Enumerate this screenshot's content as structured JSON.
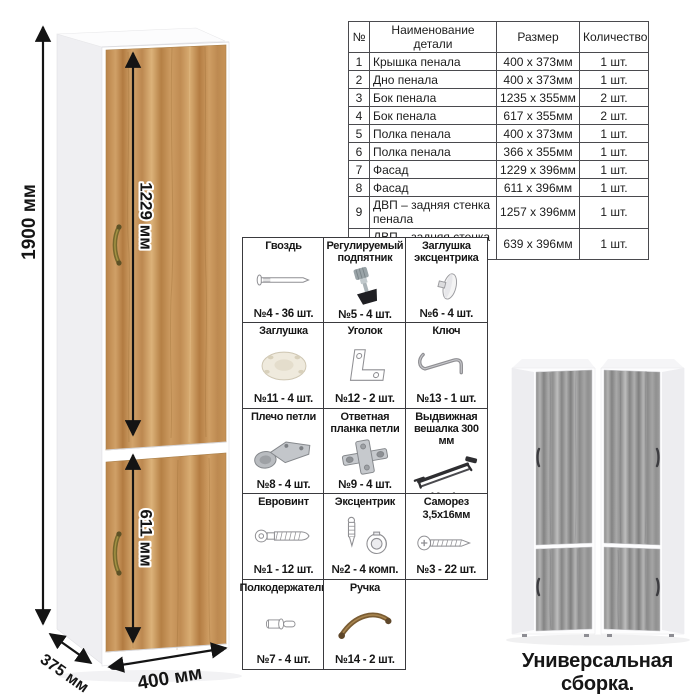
{
  "parts_table": {
    "headers": [
      "№",
      "Наименование детали",
      "Размер",
      "Количество"
    ],
    "rows": [
      [
        "1",
        "Крышка пенала",
        "400 х 373мм",
        "1 шт."
      ],
      [
        "2",
        "Дно пенала",
        "400 х 373мм",
        "1 шт."
      ],
      [
        "3",
        "Бок пенала",
        "1235 х 355мм",
        "2 шт."
      ],
      [
        "4",
        "Бок пенала",
        "617 х 355мм",
        "2 шт."
      ],
      [
        "5",
        "Полка пенала",
        "400 х 373мм",
        "1 шт."
      ],
      [
        "6",
        "Полка пенала",
        "366 х 355мм",
        "1 шт."
      ],
      [
        "7",
        "Фасад",
        "1229 х 396мм",
        "1 шт."
      ],
      [
        "8",
        "Фасад",
        "611 х 396мм",
        "1 шт."
      ],
      [
        "9",
        "ДВП – задняя стенка пенала",
        "1257 х 396мм",
        "1 шт."
      ],
      [
        "10",
        "ДВП – задняя стенка пенала",
        "639 х 396мм",
        "1 шт."
      ]
    ]
  },
  "hardware": {
    "rows": [
      [
        {
          "name": "Гвоздь",
          "qty": "№4 - 36 шт.",
          "icon": "nail-icon"
        },
        {
          "name": "Регулируемый подпятник",
          "qty": "№5 - 4 шт.",
          "icon": "adjustable-foot-icon"
        },
        {
          "name": "Заглушка эксцентрика",
          "qty": "№6 - 4 шт.",
          "icon": "cam-cap-icon"
        }
      ],
      [
        {
          "name": "Заглушка",
          "qty": "№11 - 4 шт.",
          "icon": "plug-icon"
        },
        {
          "name": "Уголок",
          "qty": "№12 - 2 шт.",
          "icon": "corner-bracket-icon"
        },
        {
          "name": "Ключ",
          "qty": "№13 - 1 шт.",
          "icon": "hex-key-icon"
        }
      ],
      [
        {
          "name": "Плечо петли",
          "qty": "№8 - 4 шт.",
          "icon": "hinge-arm-icon"
        },
        {
          "name": "Ответная планка петли",
          "qty": "№9 - 4 шт.",
          "icon": "hinge-plate-icon"
        },
        {
          "name": "Выдвижная вешалка 300 мм",
          "qty": "№10 - 1 шт.",
          "icon": "pullout-hanger-icon"
        }
      ],
      [
        {
          "name": "Евровинт",
          "qty": "№1 - 12 шт.",
          "icon": "euro-screw-icon"
        },
        {
          "name": "Эксцентрик",
          "qty": "№2 - 4 комп.",
          "icon": "cam-lock-icon"
        },
        {
          "name": "Саморез 3,5х16мм",
          "qty": "№3 - 22 шт.",
          "icon": "self-tapping-screw-icon"
        }
      ],
      [
        {
          "name": "Полкодержатель",
          "qty": "№7 - 4 шт.",
          "icon": "shelf-pin-icon"
        },
        {
          "name": "Ручка",
          "qty": "№14 - 2 шт.",
          "icon": "handle-icon"
        }
      ]
    ]
  },
  "dimensions": {
    "height": "1900 мм",
    "top_door": "1229 мм",
    "bottom_door": "611 мм",
    "depth": "375 мм",
    "width": "400 мм"
  },
  "footer": {
    "caption": "Универсальная сборка."
  },
  "colors": {
    "oak_wood": "#c79257",
    "gray_wood": "#9c9c9c",
    "handle_bronze": "#7a5c33",
    "dimension_line": "#141414",
    "table_border": "#4a4a4e"
  }
}
